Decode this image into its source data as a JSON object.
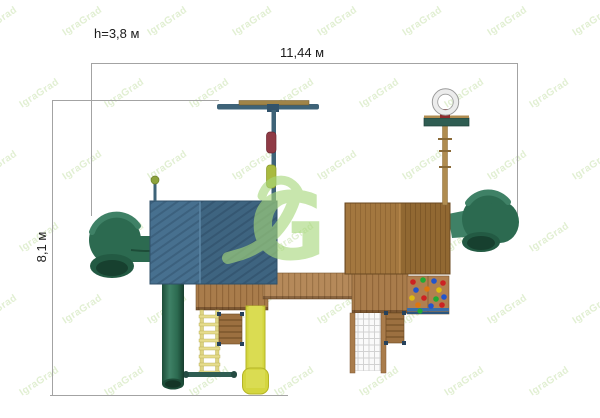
{
  "drawing": {
    "title": "playground-complex-top-view",
    "background": "#ffffff"
  },
  "dimensions": {
    "height_label": "h=3,8 м",
    "width_label": "11,44 м",
    "depth_label": "8,1 м"
  },
  "watermark": {
    "tile_text": "IgraGrad",
    "logo_letter": "G",
    "tile_color": "#9cc96a",
    "logo_color": "#a7d87b"
  },
  "palette": {
    "dimension_line": "#a3a3a3",
    "label_text": "#1b1b1b",
    "metal_teal": "#3e6378",
    "roof_blue_left": "#47708f",
    "roof_blue_right": "#3e6480",
    "roof_wood_left": "#a3773f",
    "roof_wood_right": "#916832",
    "deck_wood": "#a97c4b",
    "bridge_wood": "#b5895a",
    "tube_green": "#2c6a50",
    "tube_green_dark": "#1d4c38",
    "slide_yellow": "#d4d63f",
    "swing_red": "#8f3a45",
    "swing_green": "#a9ba3f",
    "basket_board": "#2f5d52",
    "basket_bracket": "#8e2b2b",
    "pole_wood": "#b08c50"
  }
}
